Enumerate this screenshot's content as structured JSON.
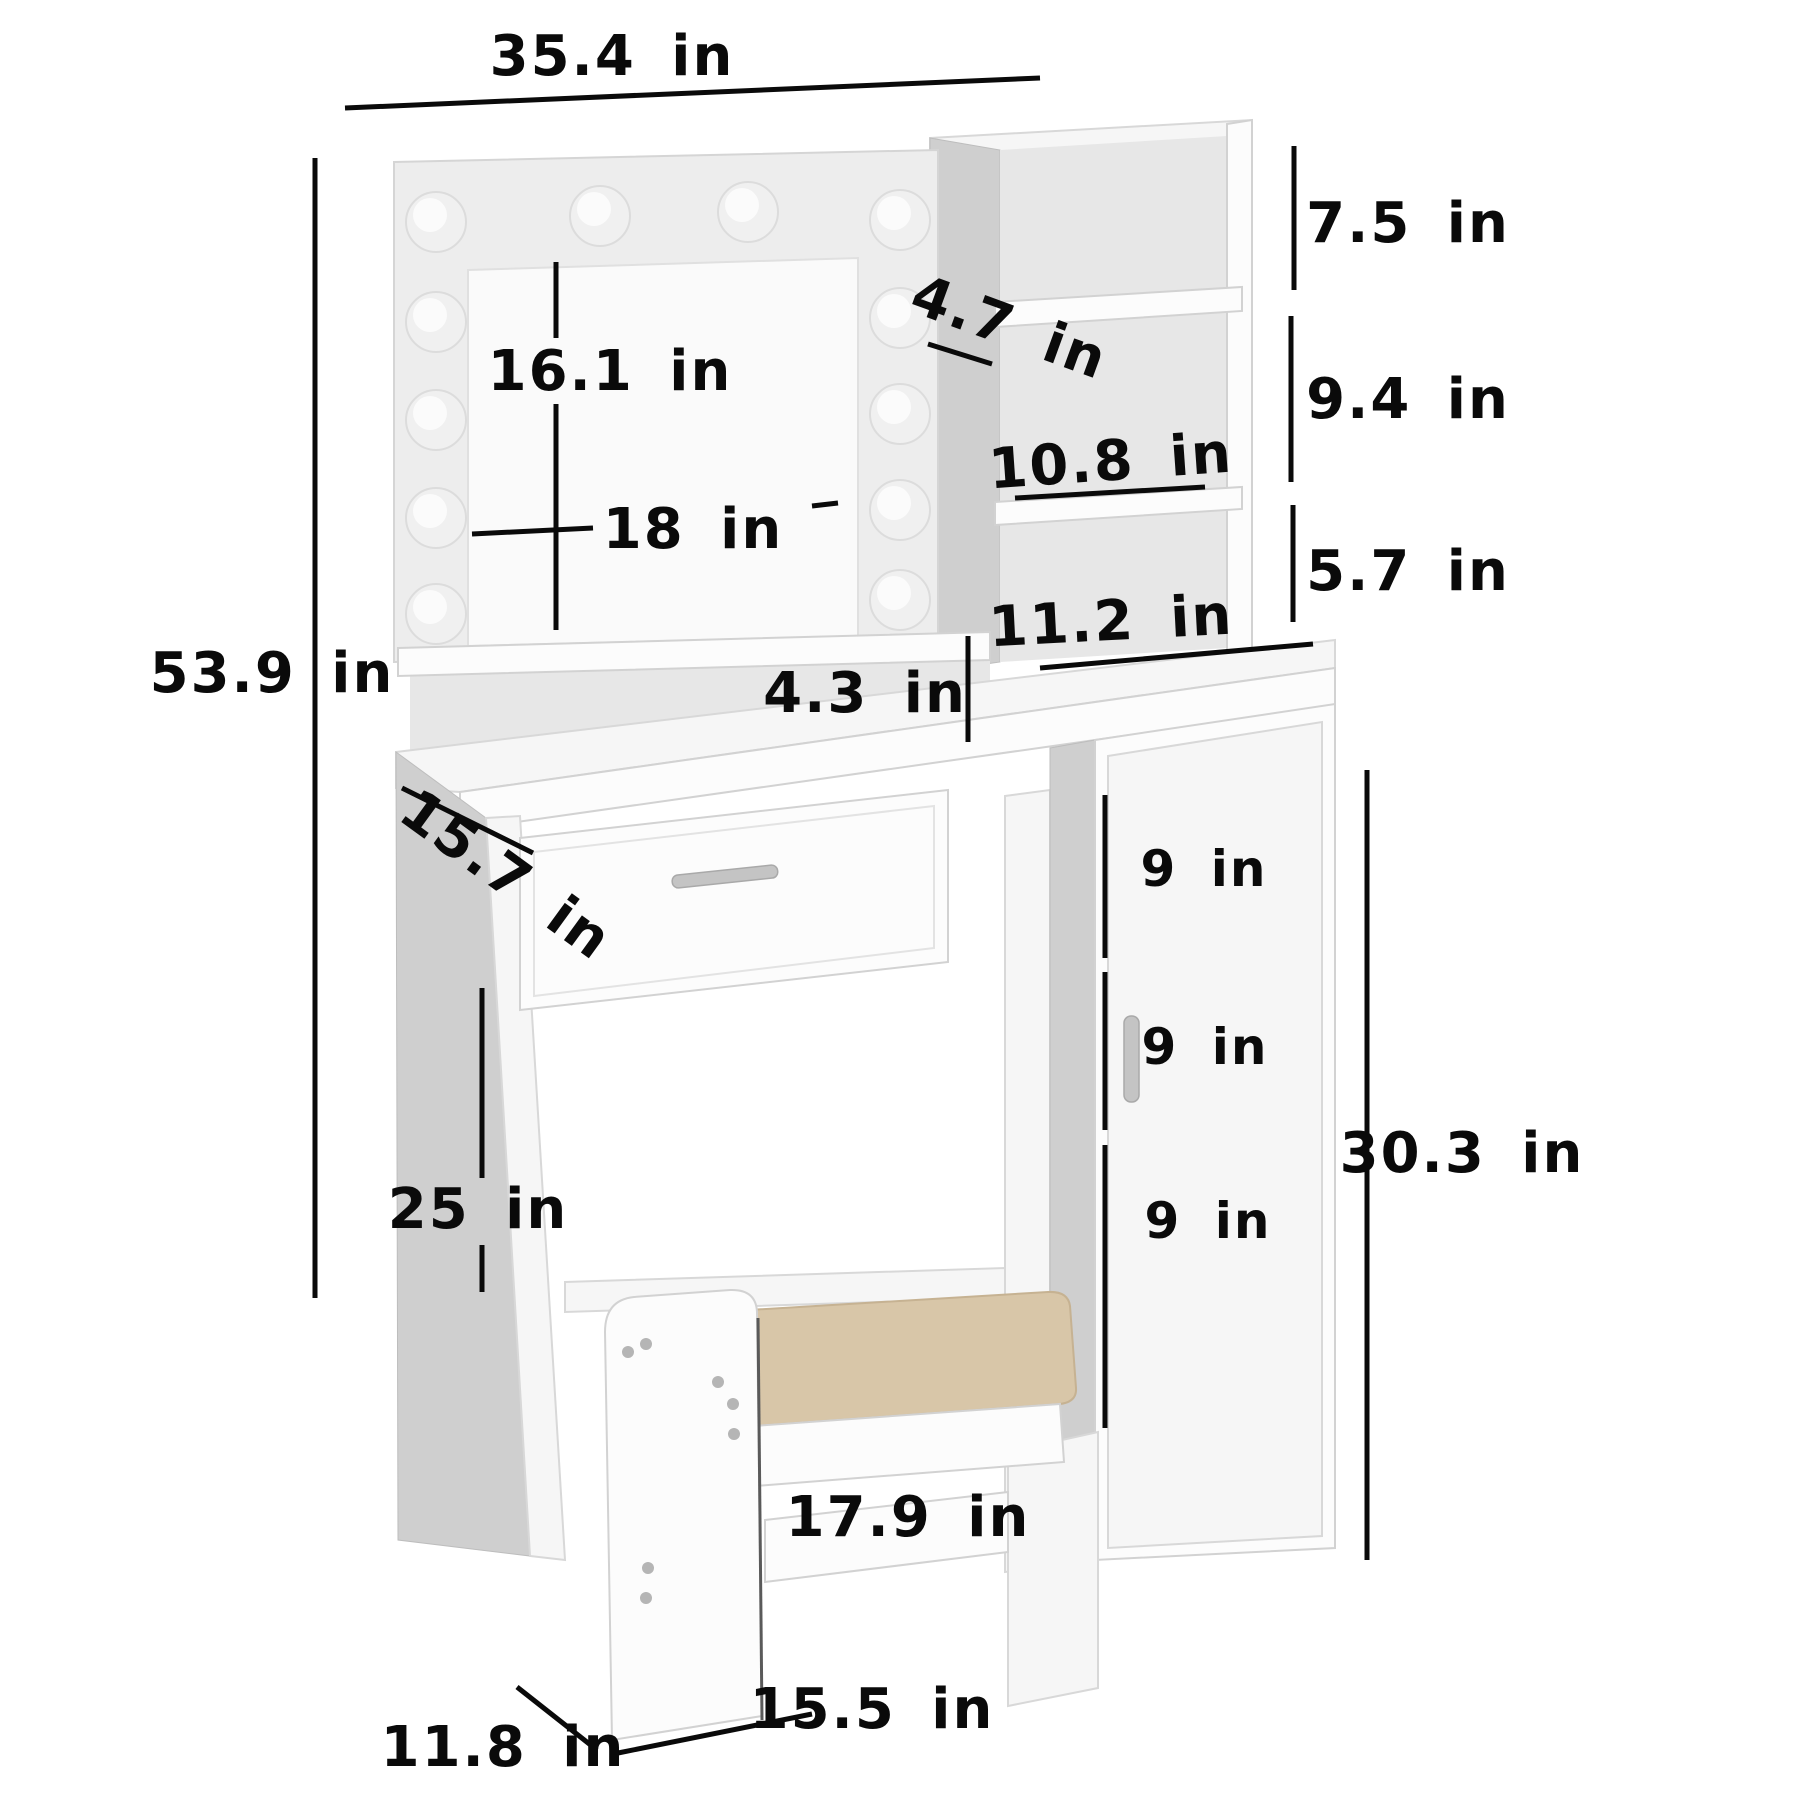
{
  "diagram": {
    "kind": "product-dimension-diagram",
    "product": "vanity-table-set-with-lighted-mirror-cabinet-and-stool",
    "unit": "in",
    "bulb_count": 12
  },
  "labels": {
    "overall_width": "35.4 in",
    "overall_height": "53.9 in",
    "mirror_height": "16.1 in",
    "mirror_width": "18 in",
    "top_shelf_depth": "4.7 in",
    "upper_cubby_height": "7.5 in",
    "middle_cubby_height": "9.4 in",
    "shelf_width": "10.8 in",
    "lower_cubby_height": "5.7 in",
    "desktop_shelf_height": "4.3 in",
    "cabinet_top_width": "11.2 in",
    "desk_depth": "15.7 in",
    "knee_space_height": "25 in",
    "cabinet_section_top": "9 in",
    "cabinet_section_middle": "9 in",
    "cabinet_section_bottom": "9 in",
    "cabinet_height": "30.3 in",
    "stool_seat_width": "17.9 in",
    "stool_base_width": "15.5 in",
    "stool_base_depth": "11.8 in"
  },
  "colors": {
    "ink": "#0a0a0a",
    "panel_white": "#fcfcfc",
    "panel_shadow": "#cfcfcf",
    "frame_gray": "#ededed",
    "back_gray": "#e7e7e7",
    "cushion_tan": "#d8c6a8",
    "handle_silver": "#c4c4c4",
    "background": "#ffffff"
  }
}
